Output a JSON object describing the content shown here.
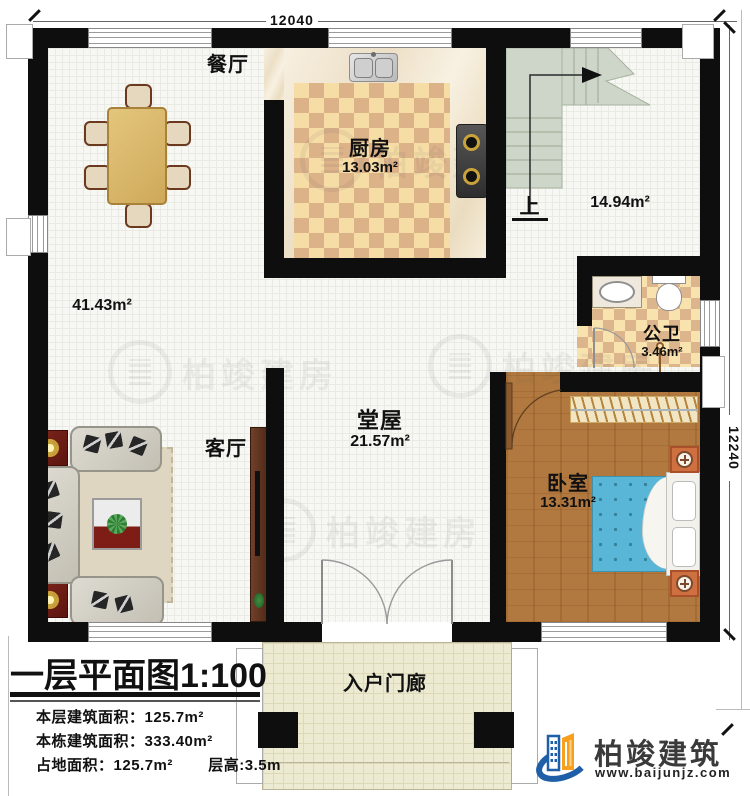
{
  "title": {
    "main": "一层平面图",
    "scale": "1:100"
  },
  "dims": {
    "top": "12040",
    "right": "12240"
  },
  "rooms": {
    "dining": {
      "name": "餐厅"
    },
    "kitchen": {
      "name": "厨房",
      "area": "13.03m²"
    },
    "stairs": {
      "up": "上",
      "area": "14.94m²"
    },
    "open": {
      "area": "41.43m²"
    },
    "bath": {
      "name": "公卫",
      "area": "3.46m²"
    },
    "hall": {
      "name": "堂屋",
      "area": "21.57m²"
    },
    "living": {
      "name": "客厅"
    },
    "bedroom": {
      "name": "卧室",
      "area": "13.31m²"
    },
    "porch": {
      "name": "入户门廊"
    }
  },
  "info": {
    "l1": {
      "label": "本层建筑面积：",
      "value": "125.7m²"
    },
    "l2": {
      "label": "本栋建筑面积：",
      "value": "333.40m²"
    },
    "l3": {
      "label": "占地面积：",
      "value": "125.7m²"
    },
    "l4": {
      "label": "层高:",
      "value": "3.5m"
    }
  },
  "branding": {
    "company": "柏竣建筑",
    "website": "www.baijunjz.com"
  },
  "watermark": {
    "text": "柏竣建房"
  },
  "colors": {
    "wall": "#0e0e0e",
    "stair_green": "#cdd6c8",
    "bed_blue": "#59b6d6",
    "bedroom_wood": "#b1793f",
    "logo_blue": "#1e5fa8",
    "logo_orange": "#f7a01d"
  }
}
